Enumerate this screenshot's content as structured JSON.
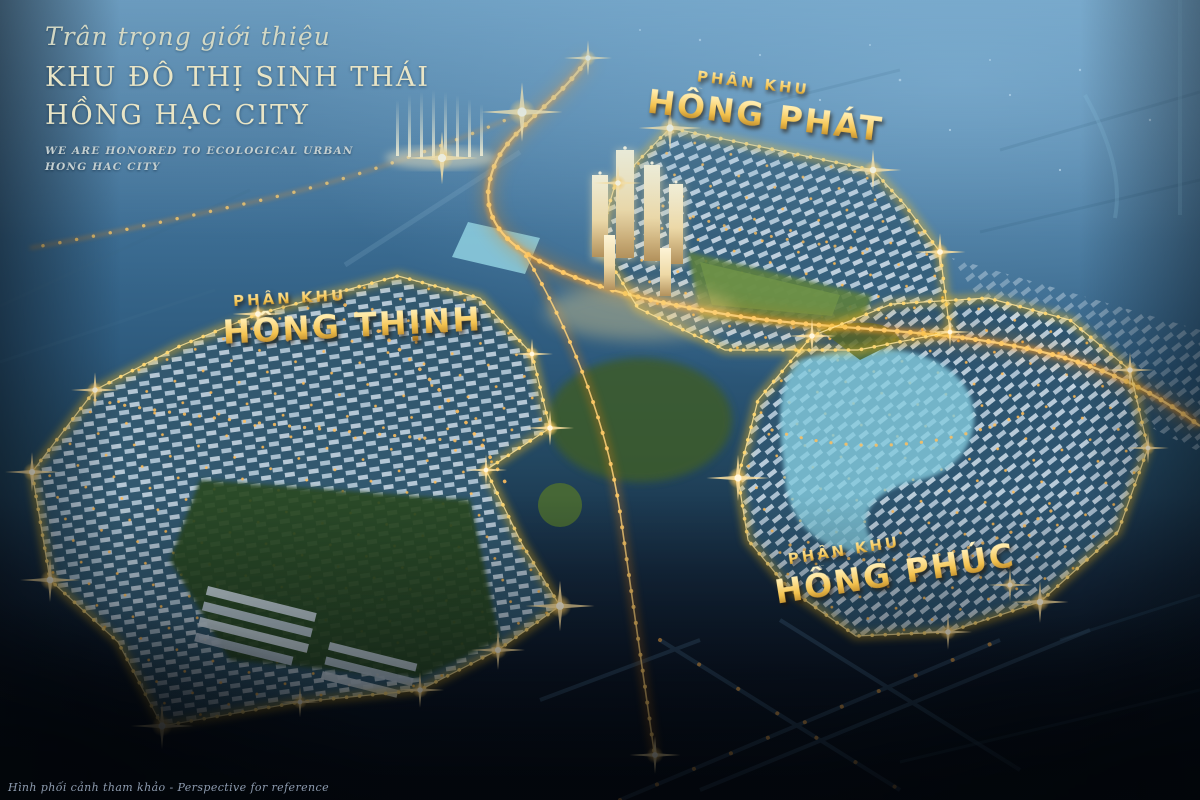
{
  "header": {
    "tagline": "Trân trọng giới thiệu",
    "title_line1": "KHU ĐÔ THỊ SINH THÁI",
    "title_line2": "HỒNG HẠC CITY",
    "subtitle_line1": "WE ARE HONORED TO ECOLOGICAL URBAN",
    "subtitle_line2": "HONG HAC CITY"
  },
  "zones": [
    {
      "id": "hong-phat",
      "prefix": "PHÂN KHU",
      "name": "HỒNG PHÁT"
    },
    {
      "id": "hong-thinh",
      "prefix": "PHÂN KHU",
      "name": "HỒNG THỊNH"
    },
    {
      "id": "hong-phuc",
      "prefix": "PHÂN KHU",
      "name": "HỒNG PHÚC"
    }
  ],
  "footer": {
    "reference_note": "Hình phối cảnh tham khảo - Perspective for reference"
  },
  "colors": {
    "gold-light": "#ffe9a6",
    "gold": "#f3c24e",
    "gold-dark": "#9a6615",
    "cream": "#e9e5c6",
    "subtitle": "#c4cfd0",
    "note": "#9cabc0",
    "boundary-glow": "#f0b81c",
    "highway-orange": "#f49a24",
    "water-cyan": "#85ccdf"
  }
}
